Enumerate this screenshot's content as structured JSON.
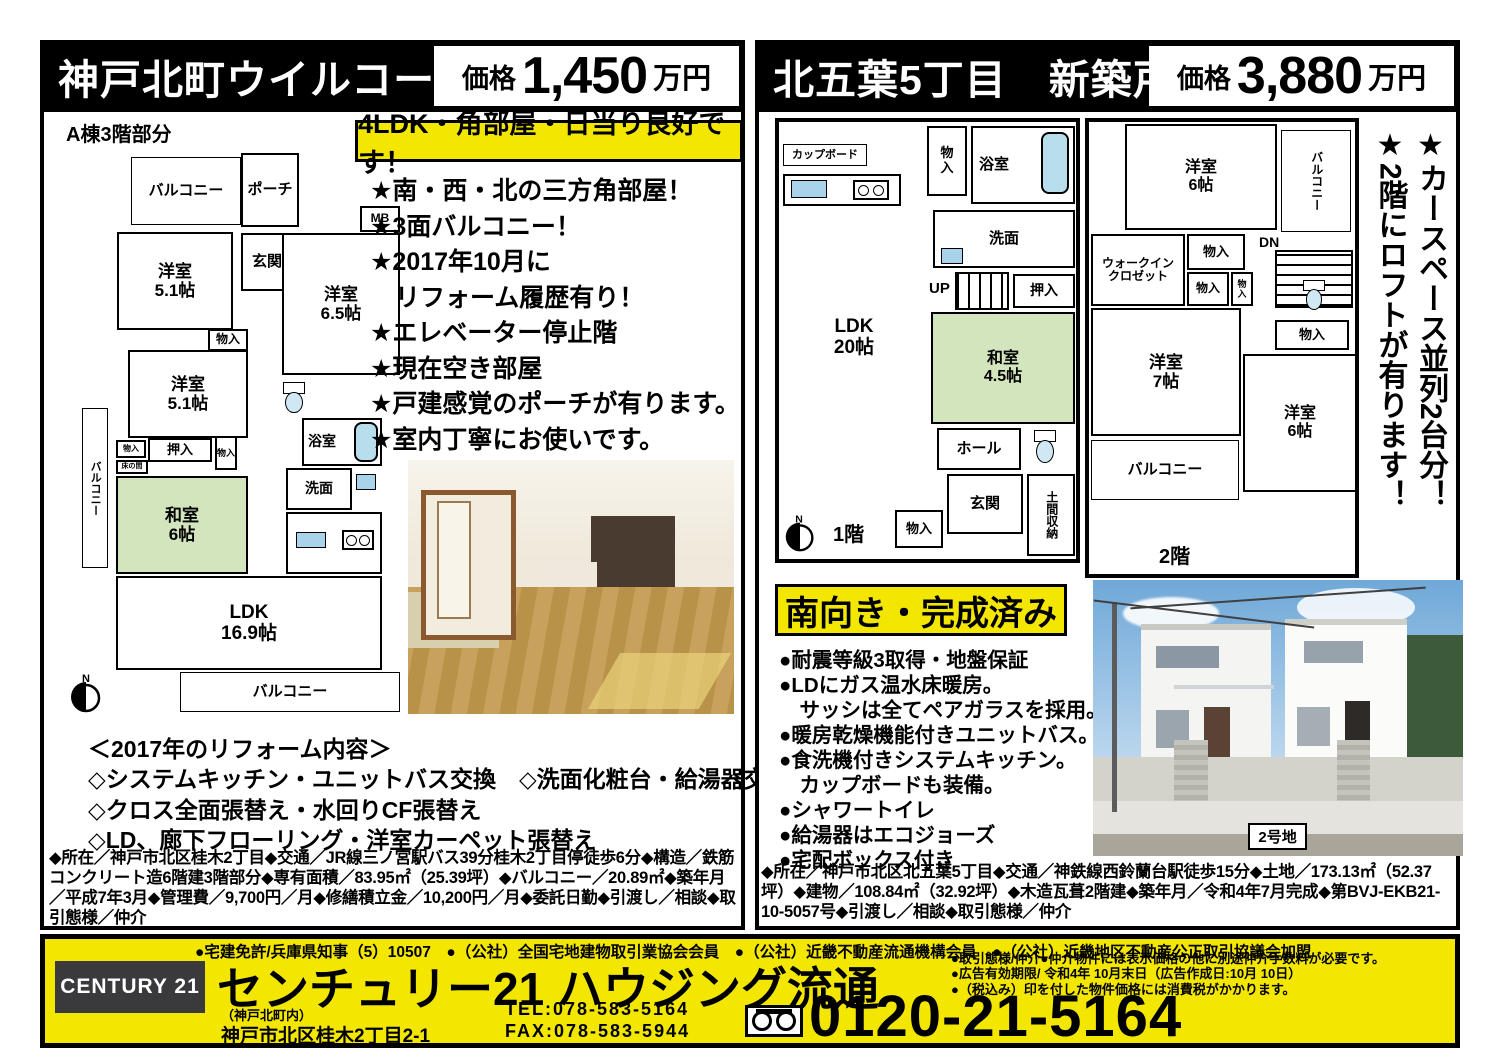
{
  "left": {
    "title": "神戸北町ウイルコート",
    "price_label": "価格",
    "price_number": "1,450",
    "price_unit": "万円",
    "building_note": "A棟3階部分",
    "highlight": "4LDK・角部屋・日当り良好です！",
    "features": [
      "★南・西・北の三方角部屋！",
      "★3面バルコニー！",
      "★2017年10月に",
      "　リフォーム履歴有り！",
      "★エレベーター停止階",
      "★現在空き部屋",
      "★戸建感覚のポーチが有ります。",
      "★室内丁寧にお使いです。"
    ],
    "reform_title": "＜2017年のリフォーム内容＞",
    "reform_items": [
      "◇システムキッチン・ユニットバス交換　◇洗面化粧台・給湯器交換",
      "◇クロス全面張替え・水回りCF張替え",
      "◇LD、廊下フローリング・洋室カーペット張替え"
    ],
    "details": "◆所在／神戸市北区桂木2丁目◆交通／JR線三ノ宮駅バス39分桂木2丁目停徒歩6分◆構造／鉄筋コンクリート造6階建3階部分◆専有面積／83.95㎡（25.39坪）◆バルコニー／20.89㎡◆築年月／平成7年3月◆管理費／9,700円／月◆修繕積立金／10,200円／月◆委託日勤◆引渡し／相談◆取引態様／仲介",
    "plan": {
      "balcony_top": "バルコニー",
      "porch": "ポーチ",
      "mb": "MB",
      "genkan": "玄関",
      "room_a": "洋室\n5.1帖",
      "room_b": "洋室\n6.5帖",
      "closet": "物入",
      "room_c": "洋室\n5.1帖",
      "balcony_left": "バルコニー",
      "closet_small": "物入",
      "oshiire": "押入",
      "closet_side": "物入",
      "tokonoma": "床の間",
      "washitsu": "和室\n6帖",
      "bath": "浴室",
      "senmen": "洗面",
      "ldk": "LDK\n16.9帖",
      "balcony_bottom": "バルコニー",
      "north": "N"
    }
  },
  "right": {
    "title": "北五葉5丁目　新築戸建",
    "price_label": "価格",
    "price_number": "3,880",
    "price_unit": "万円",
    "vertical_notes": [
      "★カースペース並列2台分！",
      "★2階にロフトが有ります！"
    ],
    "highlight": "南向き・完成済み",
    "features": [
      "●耐震等級3取得・地盤保証",
      "●LDにガス温水床暖房。",
      "　サッシは全てペアガラスを採用。",
      "●暖房乾燥機能付きユニットバス。",
      "●食洗機付きシステムキッチン。",
      "　カップボードも装備。",
      "●シャワートイレ",
      "●給湯器はエコジョーズ",
      "●宅配ボックス付き"
    ],
    "details": "◆所在／神戸市北区北五葉5丁目◆交通／神鉄線西鈴蘭台駅徒歩15分◆土地／173.13㎡（52.37坪）◆建物／108.84㎡（32.92坪）◆木造瓦葺2階建◆築年月／令和4年7月完成◆第BVJ-EKB21-10-5057号◆引渡し／相談◆取引態様／仲介",
    "photo_label": "2号地",
    "plan1f": {
      "cupboard": "カップボード",
      "closet_a": "物\n入",
      "bath": "浴室",
      "senmen": "洗面",
      "up": "UP",
      "oshiire": "押入",
      "ldk": "LDK\n20帖",
      "washitsu": "和室\n4.5帖",
      "hall": "ホール",
      "genkan": "玄関",
      "doma": "土間収納",
      "closet_b": "物入",
      "floor_label": "1階",
      "north": "N"
    },
    "plan2f": {
      "room_a": "洋室\n6帖",
      "balcony_top": "バルコニー",
      "wic": "ウォークイン\nクロゼット",
      "closet_a": "物入",
      "closet_b": "物入",
      "closet_c": "物\n入",
      "dn": "DN",
      "room_b": "洋室\n7帖",
      "closet_d": "物入",
      "room_c": "洋室\n6帖",
      "balcony_bottom": "バルコニー",
      "floor_label": "2階"
    }
  },
  "footer": {
    "license_line": "●宅建免許/兵庫県知事（5）10507　●（公社）全国宅地建物取引業協会会員　●（公社）近畿不動産流通機構会員　●（公社）近畿地区不動産公正取引協議会加盟",
    "logo": "CENTURY 21",
    "company": "センチュリー21 ハウジング流通",
    "branch": "（神戸北町内）",
    "address": "神戸市北区桂木2丁目2-1",
    "tel": "TEL:078-583-5164",
    "fax": "FAX:078-583-5944",
    "notes": [
      "●取引態様/仲介●仲介物件には表示価格の他に別途仲介手数料が必要です。",
      "●広告有効期限/ 令和4年 10月末日（広告作成日:10月 10日）",
      "●（税込み）印を付した物件価格には消費税がかかります。"
    ],
    "freedial_number": "0120-21-5164"
  },
  "colors": {
    "accent_yellow": "#f3e600",
    "tatami_green": "#d3e5bd",
    "bath_blue": "#b8ddec",
    "header_black": "#000000"
  }
}
